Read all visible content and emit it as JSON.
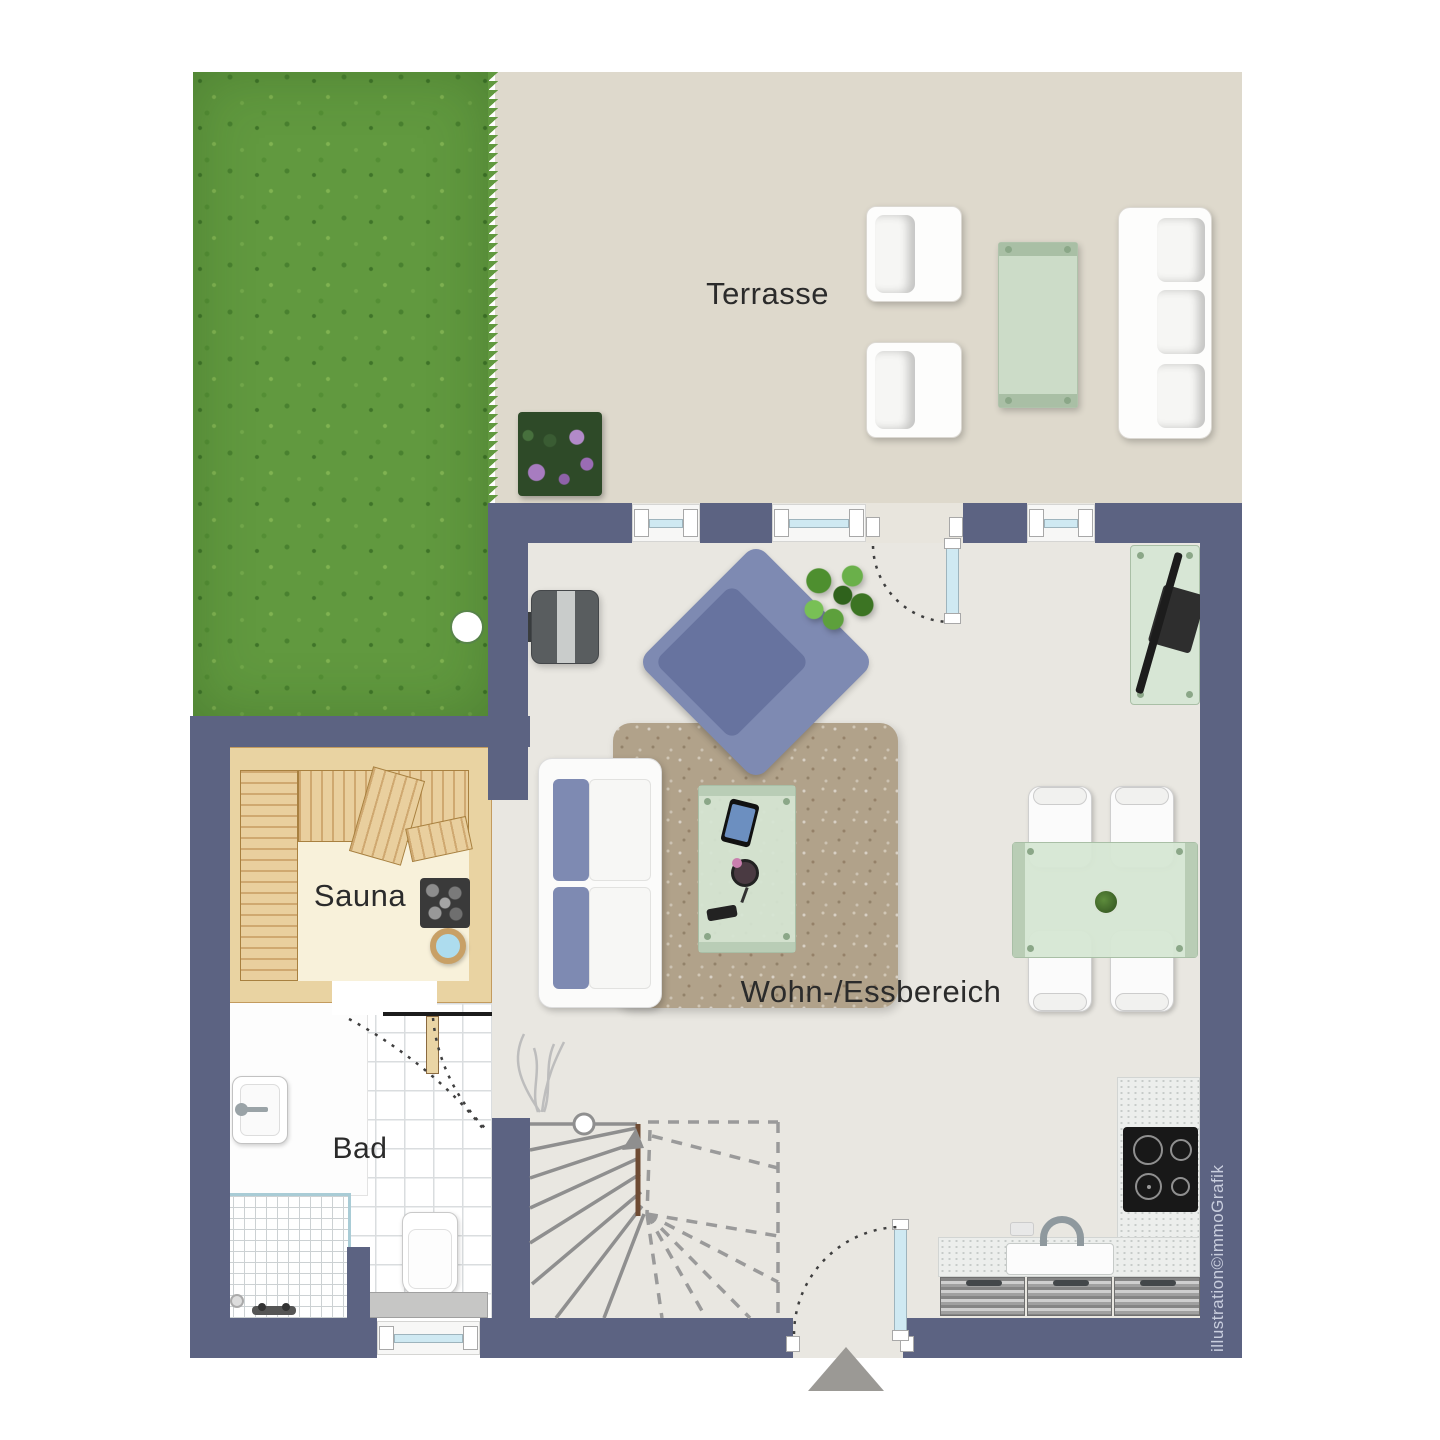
{
  "floor_plan": {
    "rooms": [
      {
        "name": "terrace",
        "label": "Terrasse"
      },
      {
        "name": "sauna",
        "label": "Sauna"
      },
      {
        "name": "bathroom",
        "label": "Bad"
      },
      {
        "name": "living-dining",
        "label": "Wohn-/Essbereich"
      }
    ],
    "watermark": "illustration©immoGrafik"
  },
  "labels": {
    "terrace": "Terrasse",
    "sauna": "Sauna",
    "bath": "Bad",
    "living_dining": "Wohn-/Essbereich",
    "watermark": "illustration©immoGrafik"
  },
  "colors": {
    "wall": "#5c6382",
    "terrace-floor": "#ded9cc",
    "interior-floor": "#e9e7e1",
    "grass": "#61993f",
    "sauna-wood": "#e9d3a2",
    "sauna-floor": "#f8f1da",
    "rug": "#b1a28a",
    "glass-green": "#d7e5d5",
    "furniture-blue": "#7e8ab2",
    "window-glass": "#cfe9f2",
    "label-text": "#2b2b2b",
    "watermark-text": "#c9cede"
  }
}
